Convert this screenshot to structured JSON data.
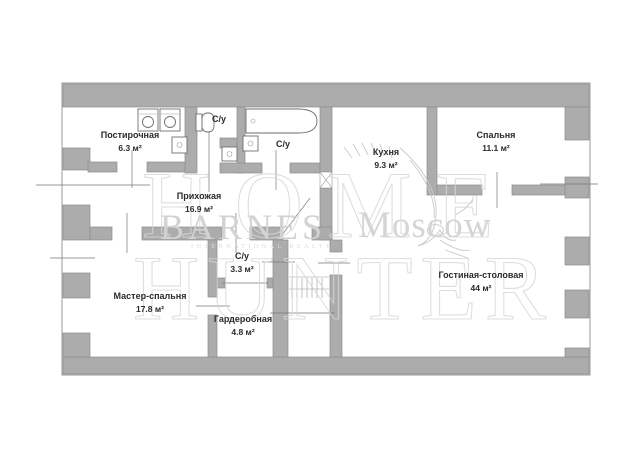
{
  "plan": {
    "rooms": [
      {
        "id": "postirochnaya",
        "name": "Постирочная",
        "area": "6.3 м²"
      },
      {
        "id": "su-top-left",
        "name": "С/у",
        "area": ""
      },
      {
        "id": "su-top-right",
        "name": "С/у",
        "area": ""
      },
      {
        "id": "kuhnya",
        "name": "Кухня",
        "area": "9.3 м²"
      },
      {
        "id": "spalnya",
        "name": "Спальня",
        "area": "11.1 м²"
      },
      {
        "id": "prihozhaya",
        "name": "Прихожая",
        "area": "16.9 м²"
      },
      {
        "id": "master-spalnya",
        "name": "Мастер-спальня",
        "area": "17.8 м²"
      },
      {
        "id": "su-lower",
        "name": "С/у",
        "area": "3.3 м²"
      },
      {
        "id": "garderobnaya",
        "name": "Гардеробная",
        "area": "4.8 м²"
      },
      {
        "id": "gostinaya-stolovaya",
        "name": "Гостиная-столовая",
        "area": "44 м²"
      }
    ],
    "watermarks": {
      "big_top": "HOME",
      "big_bottom": "HUNTER",
      "brand": "BARNES",
      "brand_subtitle": "INTERNATIONAL REALTY",
      "city": "Moscow"
    },
    "icons": [
      "washing-machine-icon",
      "toilet-icon",
      "bathtub-icon",
      "sink-icon",
      "hanger-rail-icon"
    ],
    "colors": {
      "wall": "#acacac",
      "wall_outline": "#8d8d8d",
      "thin_line": "#777777",
      "watermark_light": "#d6d6d6",
      "label_text": "#2b2b2b"
    }
  }
}
